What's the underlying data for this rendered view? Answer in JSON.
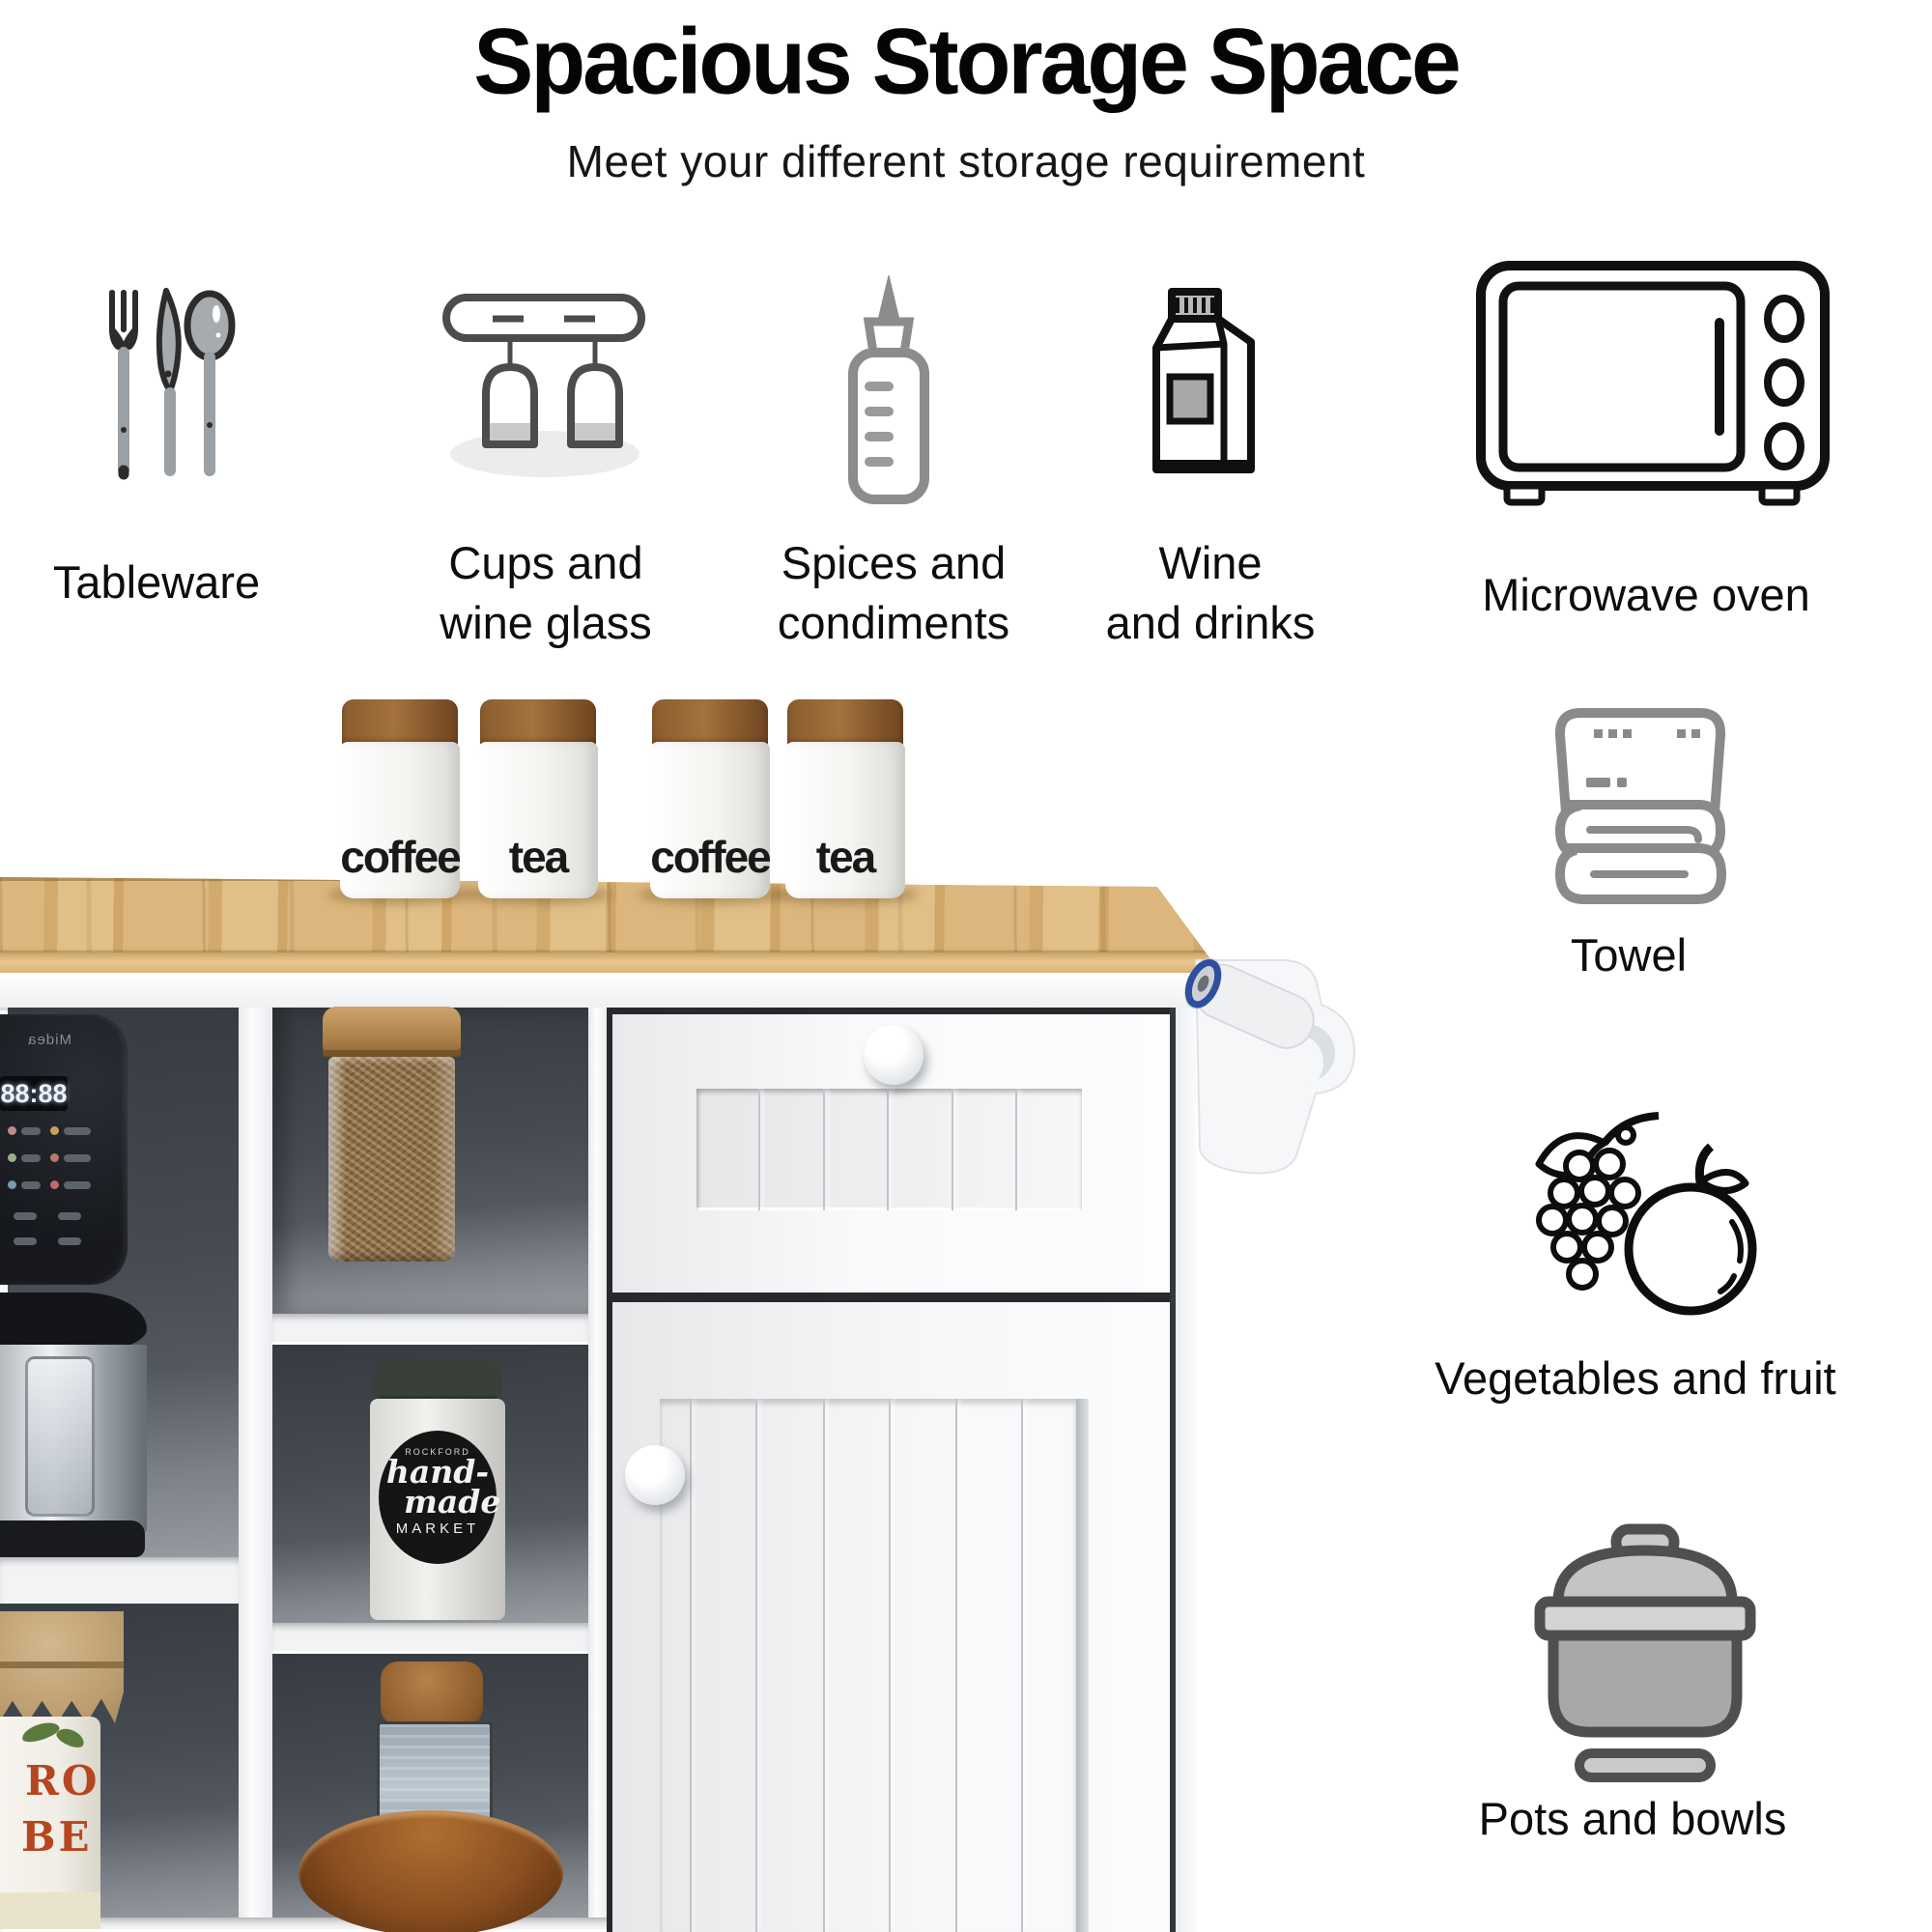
{
  "header": {
    "title": "Spacious Storage Space",
    "subtitle": "Meet your different storage requirement"
  },
  "features_top": [
    {
      "id": "tableware",
      "icon": "cutlery-icon",
      "label_lines": [
        "Tableware"
      ]
    },
    {
      "id": "cups",
      "icon": "wine-glass-rack-icon",
      "label_lines": [
        "Cups and",
        "wine glass"
      ]
    },
    {
      "id": "spices",
      "icon": "squeeze-bottle-icon",
      "label_lines": [
        "Spices and",
        "condiments"
      ]
    },
    {
      "id": "wine",
      "icon": "drink-carton-icon",
      "label_lines": [
        "Wine",
        "and drinks"
      ]
    },
    {
      "id": "microwave",
      "icon": "microwave-icon",
      "label_lines": [
        "Microwave oven"
      ]
    }
  ],
  "features_side": [
    {
      "id": "towel",
      "icon": "folded-towel-icon",
      "label": "Towel"
    },
    {
      "id": "vegetables",
      "icon": "grapes-fruit-icon",
      "label": "Vegetables and fruit"
    },
    {
      "id": "pots",
      "icon": "cooking-pot-icon",
      "label": "Pots and bowls"
    }
  ],
  "photo": {
    "canisters": [
      "coffee",
      "tea",
      "coffee",
      "tea"
    ],
    "appliance": {
      "brand": "Midea",
      "display": "88:88"
    },
    "jar_label": {
      "small_top": "ROCKFORD",
      "line1": "hand-",
      "line2": "made",
      "line3": "MARKET"
    },
    "pickle_jar": {
      "line1": "RO",
      "line2": "BE"
    }
  },
  "colors": {
    "wood_top": "#dcb67c",
    "cabinet_white": "#f7f8fa",
    "cubby_interior": "#464b52",
    "canister_lid_brown": "#8a5c2e",
    "towel_core_blue": "#2e4f9e",
    "pickle_text_red": "#b5461f"
  }
}
